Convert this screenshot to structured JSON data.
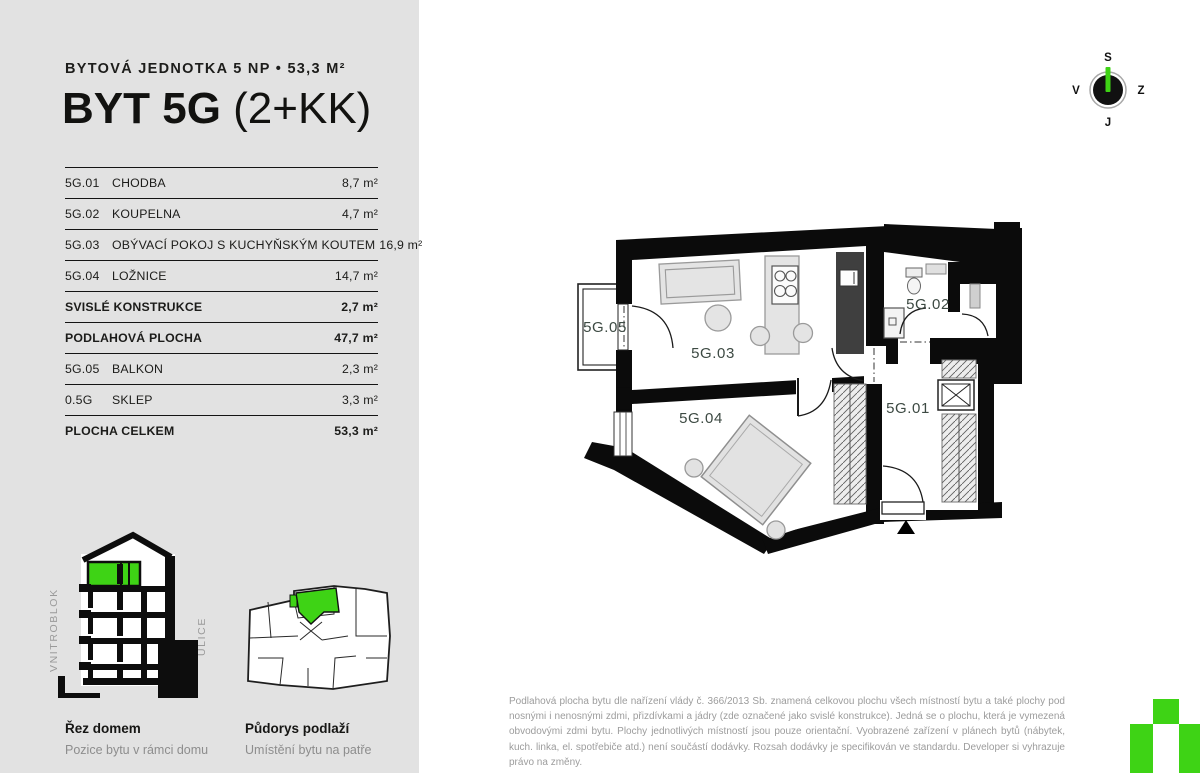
{
  "colors": {
    "accent_green": "#3ed315",
    "panel_gray": "#e2e2e2",
    "wall_black": "#0b0b0b",
    "room_label": "#3d4a43",
    "muted_text": "#9c9c9c"
  },
  "header": {
    "subtitle": "BYTOVÁ JEDNOTKA 5 NP • 53,3 M²",
    "title_main": "BYT 5G",
    "title_suffix": "(2+KK)"
  },
  "area_table": {
    "rows": [
      {
        "code": "5G.01",
        "name": "CHODBA",
        "value": "8,7 m²"
      },
      {
        "code": "5G.02",
        "name": "KOUPELNA",
        "value": "4,7 m²"
      },
      {
        "code": "5G.03",
        "name": "OBÝVACÍ POKOJ S KUCHYŇSKÝM KOUTEM",
        "value": "16,9 m²"
      },
      {
        "code": "5G.04",
        "name": "LOŽNICE",
        "value": "14,7 m²"
      },
      {
        "code": "",
        "name": "SVISLÉ KONSTRUKCE",
        "value": "2,7 m²"
      },
      {
        "code": "",
        "name": "PODLAHOVÁ PLOCHA",
        "value": "47,7 m²"
      },
      {
        "code": "5G.05",
        "name": "BALKON",
        "value": "2,3 m²"
      },
      {
        "code": "0.5G",
        "name": "SKLEP",
        "value": "3,3 m²"
      },
      {
        "code": "",
        "name": "PLOCHA CELKEM",
        "value": "53,3 m²"
      }
    ]
  },
  "floor_plan": {
    "rooms": {
      "r501": "5G.01",
      "r502": "5G.02",
      "r503": "5G.03",
      "r504": "5G.04",
      "r505": "5G.05"
    }
  },
  "compass": {
    "north": "S",
    "east": "Z",
    "south": "J",
    "west": "V"
  },
  "diagrams": {
    "section": {
      "title": "Řez domem",
      "subtitle": "Pozice bytu v rámci domu",
      "left_label": "VNITROBLOK",
      "right_label": "ULICE"
    },
    "floor": {
      "title": "Půdorys podlaží",
      "subtitle": "Umístění bytu na patře"
    }
  },
  "legal": "Podlahová plocha bytu dle nařízení vlády č. 366/2013 Sb. znamená celkovou plochu všech místností bytu a také plochy pod nosnými i nenosnými zdmi, přizdívkami a jádry (zde označené jako svislé konstrukce). Jedná se o plochu, která je vymezená obvodovými zdmi bytu. Plochy jednotlivých místností jsou pouze orientační. Vyobrazené zařízení v plánech bytů (nábytek, kuch. linka, el. spotřebiče atd.) není součástí dodávky. Rozsah dodávky je specifikován ve standardu. Developer si vyhrazuje právo na změny."
}
